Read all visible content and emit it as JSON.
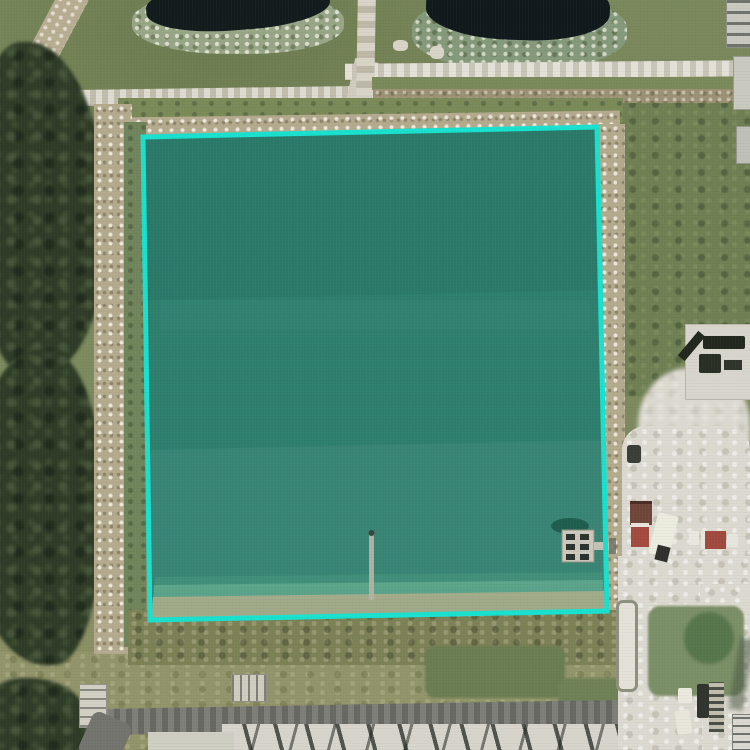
{
  "scene": {
    "view": "aerial-satellite",
    "annotation": {
      "label": "highlighted-parcel-boundary",
      "points": "143,137 597,127 607,611 150,620",
      "stroke_color": "#19E1CF",
      "stroke_width": 5,
      "water_fill": "#2E7F6E"
    },
    "palette": {
      "grass": "#7C8A5E",
      "dark_trees": "#2E3C27",
      "small_pond_water": "#121C1D",
      "white_road": "#DBD7CB",
      "dirt_embankment": "#B4AA8E",
      "sand_lot": "#DCD9D0",
      "asphalt_road": "#73746D",
      "red_container": "#A04A3C"
    },
    "features": [
      "retention-pond-highlighted",
      "small-pond-top-left",
      "small-pond-top-right",
      "access-roads",
      "tree-line-west",
      "pump-platform",
      "dock-walkway",
      "equipment-yard-east",
      "containers-and-trucks",
      "construction-area-south",
      "vehicles-southeast"
    ]
  }
}
